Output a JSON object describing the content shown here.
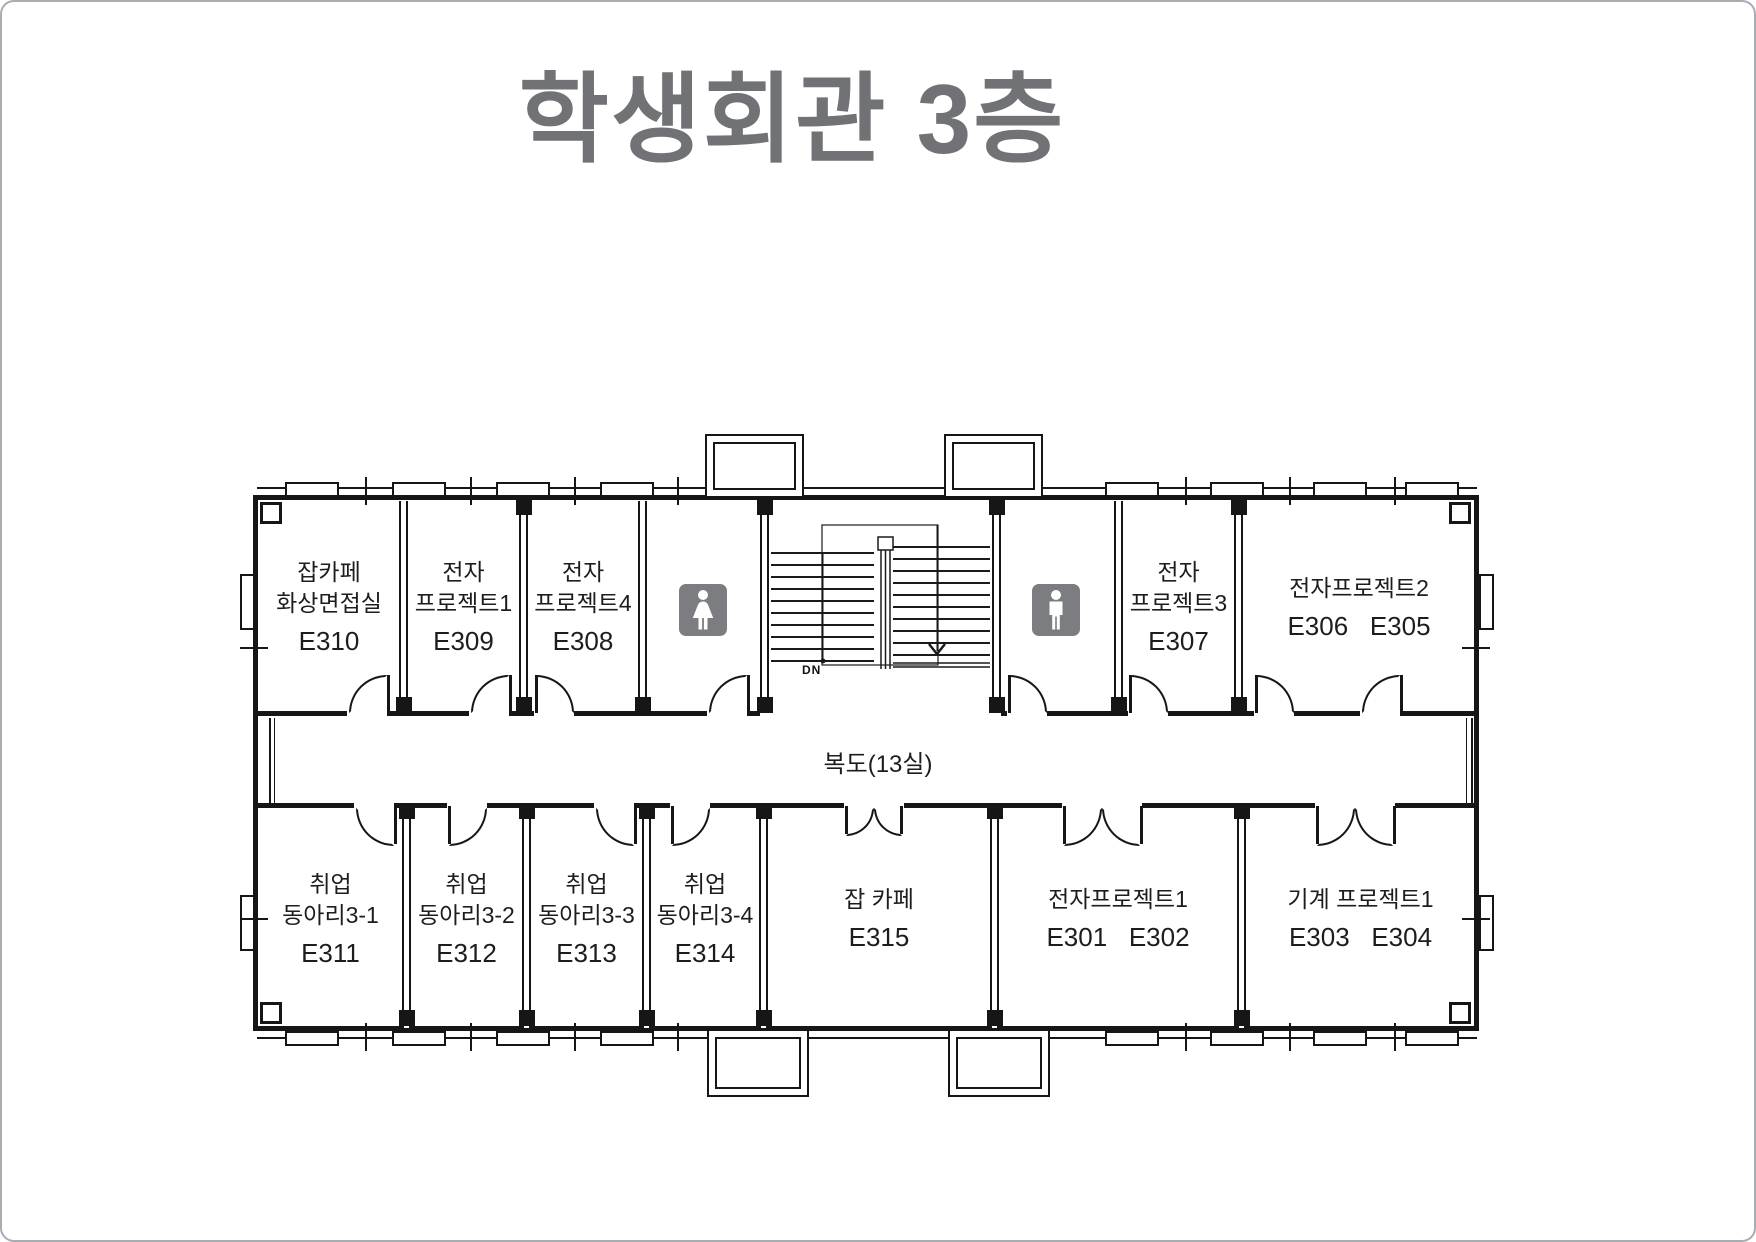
{
  "title": "학생회관 3층",
  "plan": {
    "corridor_label": "복도(13실)",
    "stairs_down_label": "DN",
    "icons": {
      "women": "female-restroom",
      "men": "male-restroom"
    }
  },
  "rooms": {
    "e310": {
      "line1": "잡카페",
      "line2": "화상면접실",
      "number": "E310"
    },
    "e309": {
      "line1": "전자",
      "line2": "프로젝트1",
      "number": "E309"
    },
    "e308": {
      "line1": "전자",
      "line2": "프로젝트4",
      "number": "E308"
    },
    "e307": {
      "line1": "전자",
      "line2": "프로젝트3",
      "number": "E307"
    },
    "e306_e305": {
      "line1": "전자프로젝트2",
      "number": "E306   E305"
    },
    "e311": {
      "line1": "취업",
      "line2": "동아리3-1",
      "number": "E311"
    },
    "e312": {
      "line1": "취업",
      "line2": "동아리3-2",
      "number": "E312"
    },
    "e313": {
      "line1": "취업",
      "line2": "동아리3-3",
      "number": "E313"
    },
    "e314": {
      "line1": "취업",
      "line2": "동아리3-4",
      "number": "E314"
    },
    "e315": {
      "line1": "잡 카페",
      "number": "E315"
    },
    "e301_e302": {
      "line1": "전자프로젝트1",
      "number": "E301   E302"
    },
    "e303_e304": {
      "line1": "기계 프로젝트1",
      "number": "E303   E304"
    }
  },
  "colors": {
    "title": "#717276",
    "wall": "#161616",
    "icon_bg": "#7b7d81"
  }
}
